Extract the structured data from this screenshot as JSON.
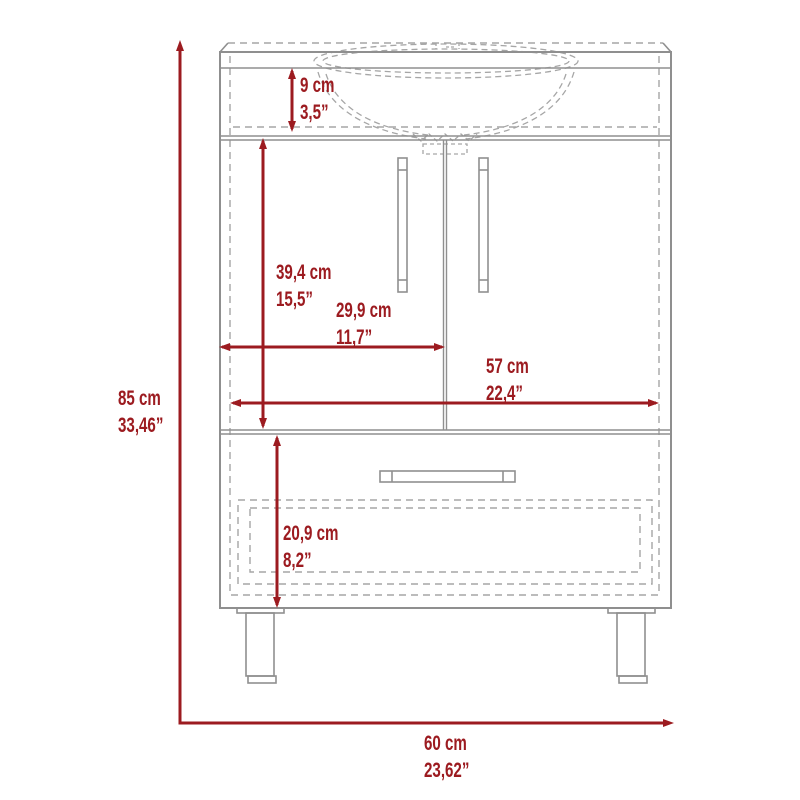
{
  "diagram": {
    "subject": "Bathroom vanity cabinet with sink, two doors and one drawer - front elevation dimension drawing",
    "background_color": "#ffffff",
    "dimension_color": "#9c1b20",
    "outline_color": "#8f8f8f",
    "hidden_line_color": "#a6a6a6"
  },
  "dimensions": {
    "sink_apron_height": {
      "cm": "9 cm",
      "inch": "3,5”"
    },
    "door_height": {
      "cm": "39,4 cm",
      "inch": "15,5”"
    },
    "door_width": {
      "cm": "29,9 cm",
      "inch": "11,7”"
    },
    "interior_width": {
      "cm": "57 cm",
      "inch": "22,4”"
    },
    "overall_height": {
      "cm": "85 cm",
      "inch": "33,46”"
    },
    "drawer_height": {
      "cm": "20,9 cm",
      "inch": "8,2”"
    },
    "overall_width": {
      "cm": "60 cm",
      "inch": "23,62”"
    }
  }
}
